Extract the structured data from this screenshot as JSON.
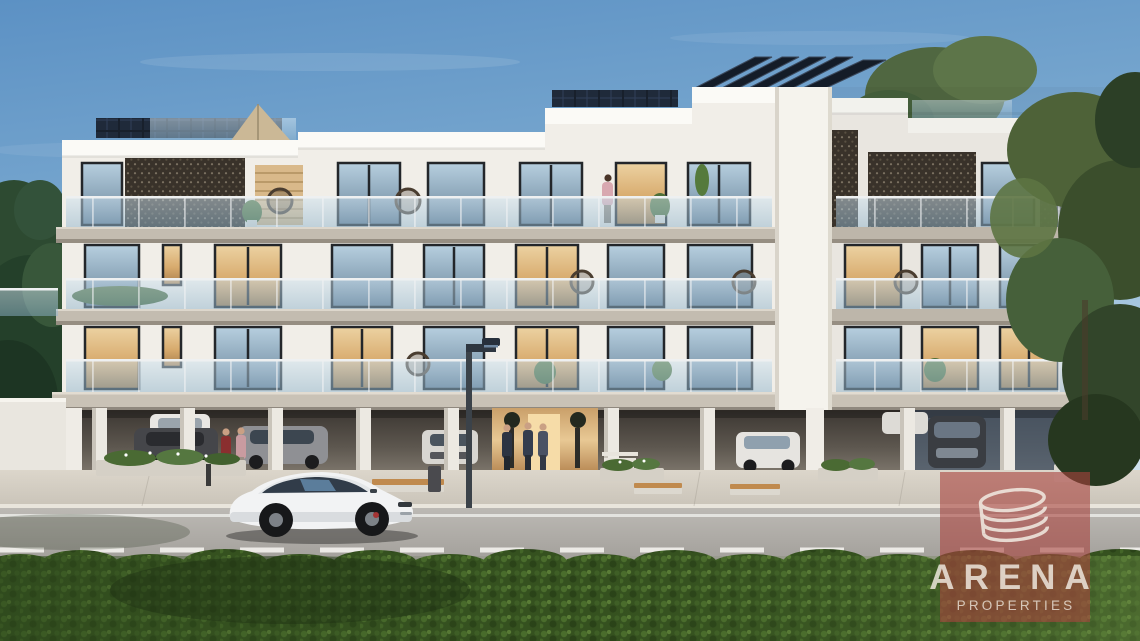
{
  "watermark": {
    "brand": "ARENA",
    "subtitle": "PROPERTIES",
    "overlay_color": "#a8433d",
    "logo_icon": "swirl-coil-icon"
  },
  "palette": {
    "sky_top": "#5c91c4",
    "sky_horizon": "#cfe1ee",
    "building_white": "#f1eee8",
    "fascia_white": "#fbfaf6",
    "slab_concrete": "#c3bcb0",
    "screen_bronze": "#39322a",
    "balcony_glass": "#a9c8dc",
    "solar_panel": "#151d29",
    "warm_interior": "#e6bd86",
    "road": "#b1aea9",
    "sidewalk": "#d6d0c5",
    "hedge_green": "#3a5724",
    "bench_wood": "#c08a4e",
    "foreground_car": "#f2f3f4"
  },
  "scene": {
    "type": "3d-architectural-exterior-render",
    "description": "Modern three-storey white apartment building with glass balconies, bronze perforated facade screens, rooftop solar panels and open ground-level parking, seen from the street across a green hedge.",
    "elements": [
      "sky",
      "trees",
      "apartment building",
      "rooftop solar panels",
      "sail shade",
      "perforated screens",
      "glass balustrades",
      "balcony plants and hanging chairs",
      "ground-floor parking with cars",
      "lit lobby entrance with residents",
      "street lamp",
      "benches",
      "planters",
      "white sports sedan on road",
      "road markings",
      "green hedge",
      "red watermark badge"
    ],
    "parked_cars": 7,
    "driving_cars": 1,
    "people_visible": 6
  }
}
